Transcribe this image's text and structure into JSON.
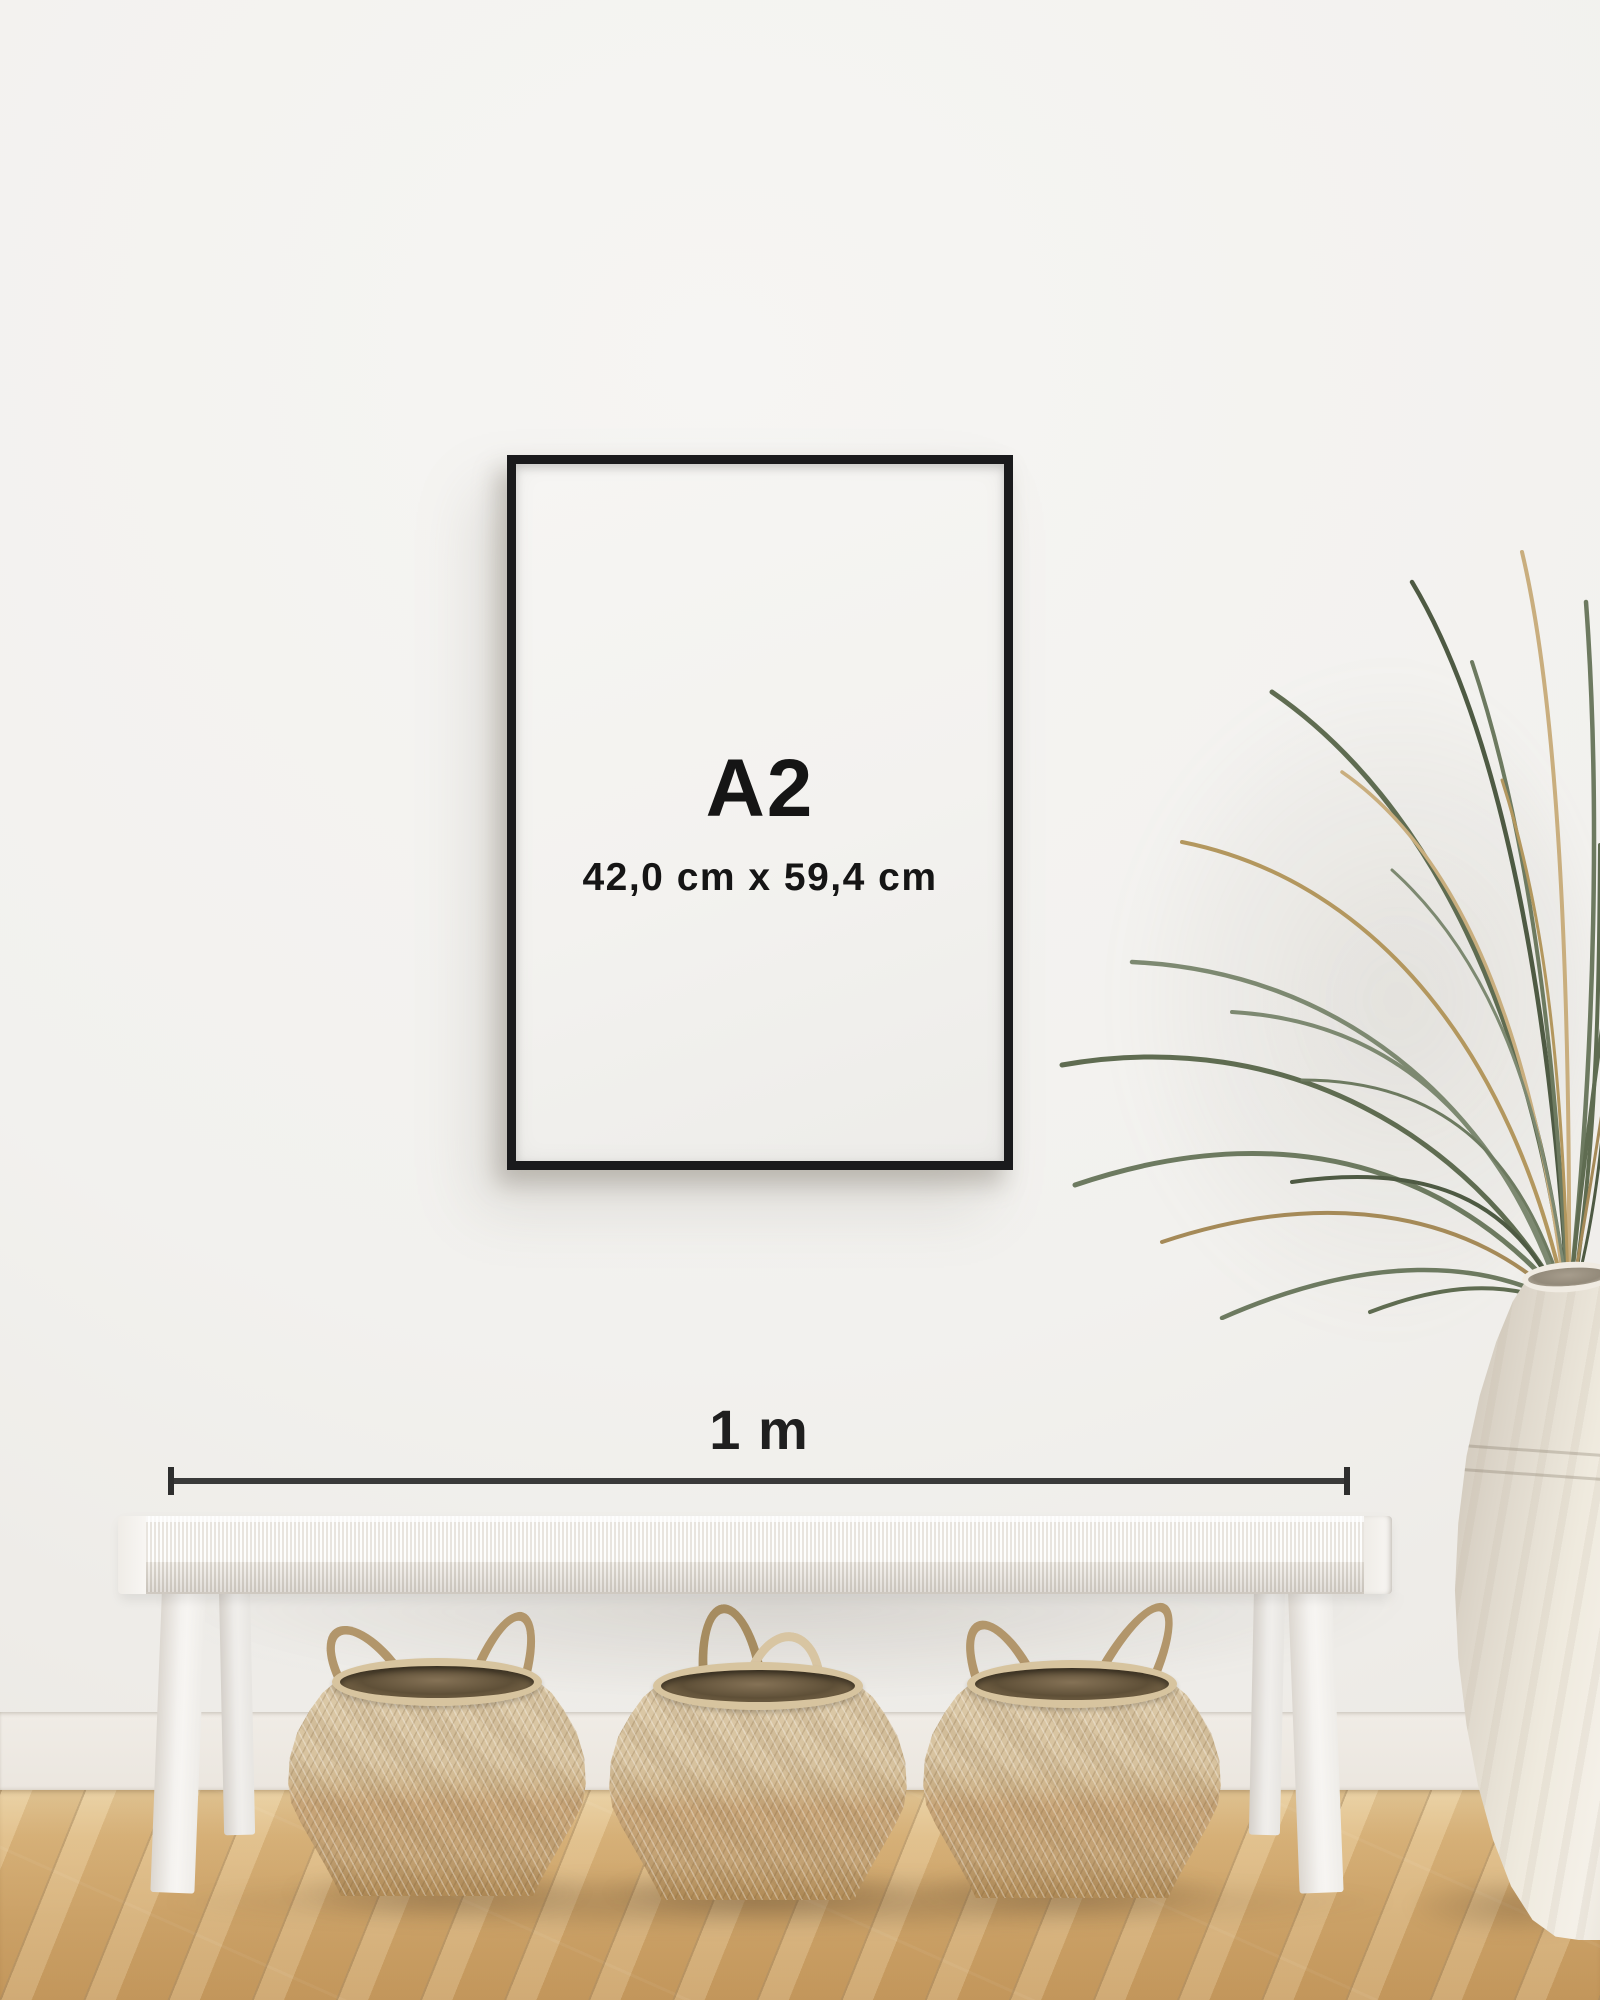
{
  "frame": {
    "size_label": "A2",
    "dimensions_label": "42,0 cm x 59,4 cm"
  },
  "scale_bar": {
    "label": "1 m"
  },
  "colors": {
    "wall": "#f2f1ee",
    "baseboard": "#eee9e2",
    "floor_wood": "#d0a76c",
    "frame": "#1a1a1c",
    "poster_paper": "#f4f3f0",
    "label_text": "#151515",
    "dimension_line": "#3a3a3a",
    "bench_white": "#f5f3f0",
    "basket_weave": "#cdb48c",
    "basket_interior": "#5f5038",
    "rope_handle": "#b2966b",
    "plant_green": "#5f6c51",
    "plant_dried": "#b3975e",
    "vase_ceramic": "#efeade"
  }
}
